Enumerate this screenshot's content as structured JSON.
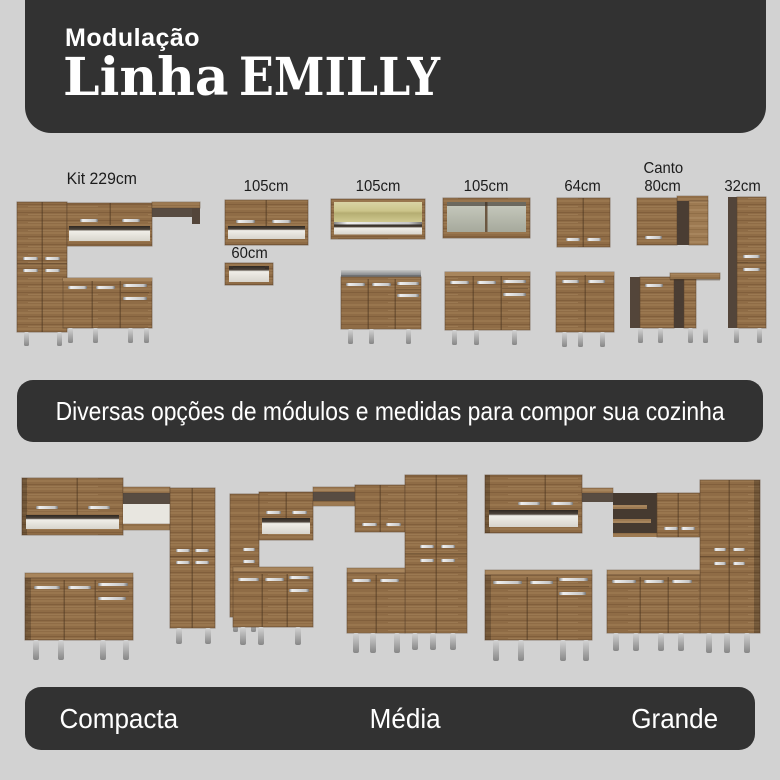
{
  "header": {
    "subtitle": "Modulação",
    "title_primary": "Linha",
    "title_secondary": "EMILLY"
  },
  "modules": [
    {
      "label": "Kit 229cm"
    },
    {
      "label": "105cm",
      "sub_label": "60cm"
    },
    {
      "label": "105cm"
    },
    {
      "label": "105cm"
    },
    {
      "label": "64cm"
    },
    {
      "label_line1": "Canto",
      "label_line2": "80cm"
    },
    {
      "label": "32cm"
    }
  ],
  "banner": {
    "text": "Diversas opções de módulos e medidas para compor sua cozinha"
  },
  "kitchen_sizes": [
    {
      "label": "Compacta"
    },
    {
      "label": "Média"
    },
    {
      "label": "Grande"
    }
  ],
  "colors": {
    "background": "#d2d2d2",
    "panel": "#323232",
    "text_dark": "#1c1c1c",
    "text_light": "#ffffff",
    "wood": "#8f6c46",
    "wood_light": "#9d7a52",
    "wood_dark": "#5a422b",
    "side_panel": "#53453a",
    "interior_white": "#f0eee8",
    "metal_handle": "#d9d9d9",
    "leg_silver": "#b4b4b4",
    "countertop_gray": "#9b9d9f",
    "glass_tint": "#cbc489"
  }
}
